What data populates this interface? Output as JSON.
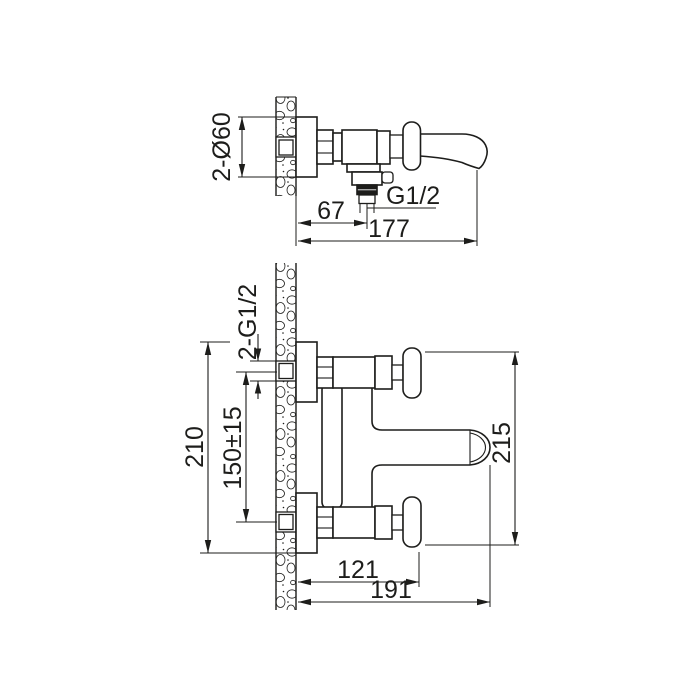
{
  "page": {
    "background": "#ffffff",
    "line_color": "#1d1d1b",
    "description": "Bath mixer faucet installation dimension drawing, two orthographic views on wall section"
  },
  "side_view": {
    "dim_escutcheon_diameter": "2-Ø60",
    "dim_shower_outlet_offset": "67",
    "dim_outlet_thread": "G1/2",
    "dim_overall_depth": "177"
  },
  "front_view": {
    "dim_connection_thread": "2-G1/2",
    "dim_overall_height": "210",
    "dim_connection_spacing": "150±15",
    "dim_body_height": "215",
    "dim_handle_reach": "121",
    "dim_spout_reach": "191"
  }
}
